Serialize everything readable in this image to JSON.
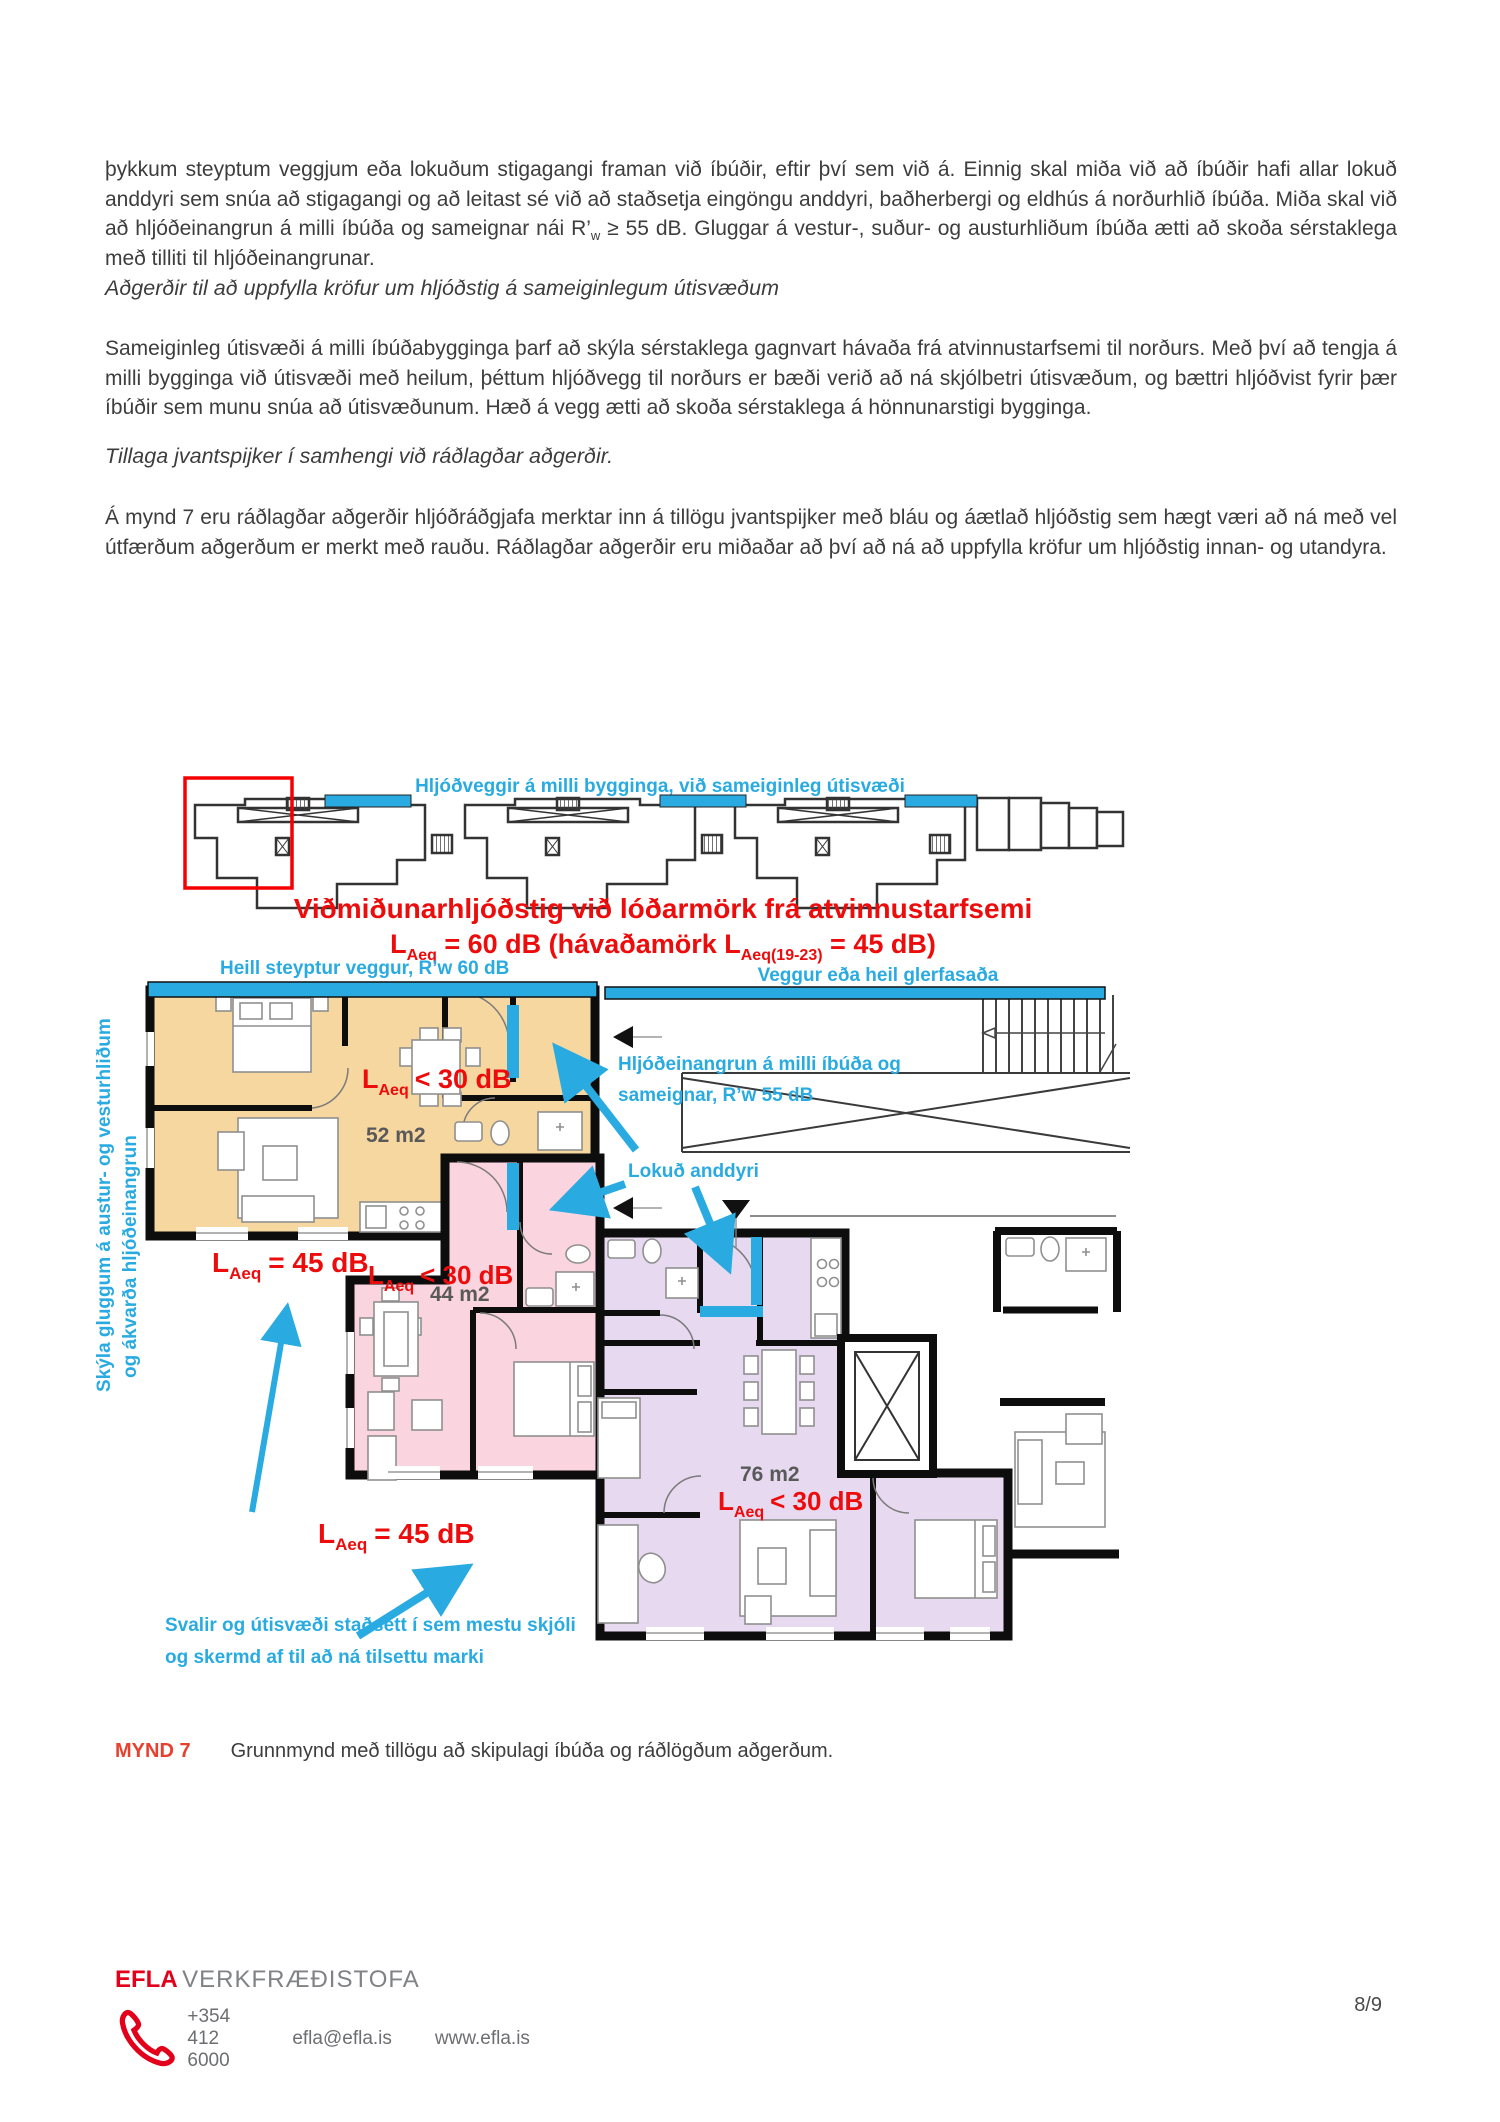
{
  "page": {
    "number": "8/9"
  },
  "colors": {
    "accent_blue": "#29abe2",
    "annotation_red": "#ec0c0c",
    "brand_red": "#e2001a",
    "apartment_orange": "#f6d7a0",
    "apartment_pink": "#fad4de",
    "apartment_purple": "#e7daf0"
  },
  "document": {
    "p1a": "þykkum steyptum veggjum eða lokuðum stigagangi framan við íbúðir, eftir því sem við á. Einnig skal miða við að íbúðir hafi allar lokuð anddyri sem snúa að stigagangi og að leitast sé við að staðsetja eingöngu anddyri, baðherbergi og eldhús á norðurhlið íbúða. Miða skal við að hljóðeinangrun á milli íbúða og sameignar nái R’",
    "p1sub": "w",
    "p1b": " ≥ 55 dB. Gluggar á vestur-, suður- og austurhliðum íbúða ætti að skoða sérstaklega með tilliti til hljóðeinangrunar.",
    "h1": "Aðgerðir til að uppfylla kröfur um hljóðstig á sameiginlegum útisvæðum",
    "p2": "Sameiginleg útisvæði á milli íbúðabygginga þarf að skýla sérstaklega gagnvart hávaða frá atvinnustarfsemi til norðurs. Með því að tengja á milli bygginga við útisvæði með heilum, þéttum hljóðvegg til norðurs er bæði verið að ná skjólbetri útisvæðum, og bættri hljóðvist fyrir þær íbúðir sem munu snúa að útisvæðunum. Hæð á vegg ætti að skoða sérstaklega á hönnunarstigi bygginga.",
    "h2": "Tillaga jvantspijker í samhengi við ráðlagðar aðgerðir.",
    "p3": "Á mynd 7 eru ráðlagðar aðgerðir hljóðráðgjafa merktar inn á tillögu jvantspijker með bláu og áætlað hljóðstig sem hægt væri að ná með vel útfærðum aðgerðum er merkt með rauðu. Ráðlagðar aðgerðir eru miðaðar að því að ná að uppfylla kröfur um hljóðstig innan- og utandyra."
  },
  "figure": {
    "site_label": "Hljóðveggir á milli bygginga, við sameiginleg útisvæði",
    "red_title": "Viðmiðunarhljóðstig við lóðarmörk frá atvinnustarfsemi",
    "red_sub": {
      "l1": "L",
      "s1": "Aeq",
      "m": " = 60 dB (hávaðamörk L",
      "s2": "Aeq(19-23)",
      "e": " = 45 dB)"
    },
    "wall_left": "Heill steyptur veggur, R’w 60 dB",
    "wall_right": "Veggur eða heil glerfasaða",
    "insul1": "Hljóðeinangrun á milli íbúða og",
    "insul2": "sameignar, R’w 55 dB",
    "anddyri": "Lokuð anddyri",
    "svalir1": "Svalir og útisvæði staðsett í sem mestu skjóli",
    "svalir2": "og skermd af til að ná tilsettu marki",
    "rot1": "Skýla gluggum á austur- og vesturhliðum",
    "rot2": "og ákvarða hljóðeinangrun",
    "l": "L",
    "aeq": "Aeq",
    "lt30": "< 30 dB",
    "eq45": "= 45 dB",
    "area52": "52 m2",
    "area44": "44 m2",
    "area76": "76 m2"
  },
  "caption": {
    "label": "MYND 7",
    "text": "Grunnmynd með tillögu að skipulagi íbúða og ráðlögðum aðgerðum."
  },
  "footer": {
    "brand": "EFLA",
    "brand_suffix": "VERKFRÆÐISTOFA",
    "phone": "+354 412 6000",
    "email": "efla@efla.is",
    "web": "www.efla.is"
  }
}
